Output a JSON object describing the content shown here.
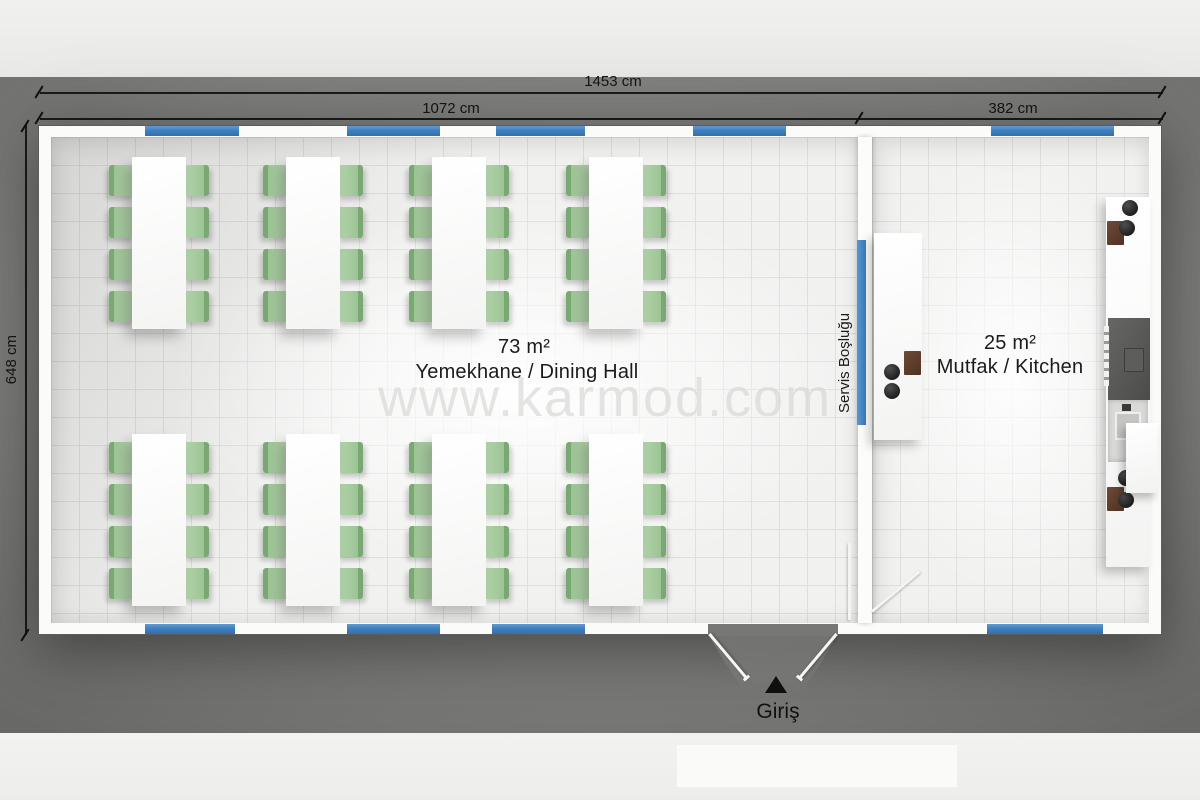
{
  "page": {
    "type": "prefab building floor plan",
    "watermark": "www.karmod.com"
  },
  "dimensions": {
    "total_width": "1453 cm",
    "dining_width": "1072 cm",
    "kitchen_width": "382 cm",
    "depth": "648 cm"
  },
  "rooms": {
    "dining": {
      "area": "73 m²",
      "name": "Yemekhane / Dining Hall",
      "tables": 8,
      "seats_per_table": 8
    },
    "kitchen": {
      "area": "25 m²",
      "name": "Mutfak / Kitchen"
    }
  },
  "service": {
    "label": "Servis Boşluğu"
  },
  "entrance": {
    "label": "Giriş"
  },
  "colors": {
    "window_blue": "#3e80c0",
    "chair_green": "#9cc494",
    "mat_gray": "#7e7e7c",
    "floor": "#f1f1f0"
  }
}
